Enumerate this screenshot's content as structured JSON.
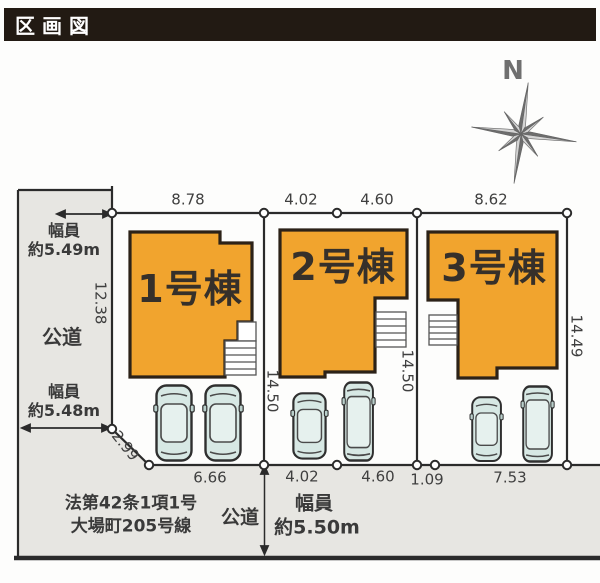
{
  "header": {
    "title": "区画図"
  },
  "compass": {
    "north_label": "N"
  },
  "dims": {
    "top": [
      "8.78",
      "4.02",
      "4.60",
      "8.62"
    ],
    "bottom": [
      "6.66",
      "4.02",
      "4.60",
      "1.09",
      "7.53"
    ],
    "left_boundary": "12.38",
    "corner_diagonal": "2.99",
    "plot2_left": "14.50",
    "plot2_right": "14.50",
    "plot3_right": "14.49"
  },
  "left_road": {
    "width_top_line1": "幅員",
    "width_top_line2": "約5.49m",
    "name": "公道",
    "width_bottom_line1": "幅員",
    "width_bottom_line2": "約5.48m"
  },
  "bottom_road": {
    "law_line1": "法第42条1項1号",
    "law_line2": "大場町205号線",
    "name": "公道",
    "width_line1": "幅員",
    "width_line2": "約5.50m"
  },
  "buildings": [
    {
      "label": "1号棟"
    },
    {
      "label": "2号棟"
    },
    {
      "label": "3号棟"
    }
  ],
  "colors": {
    "building_fill": "#F1A42E",
    "building_outline": "#2C2218",
    "road_fill": "#E7E6E2",
    "line": "#2B2B2B",
    "car_body": "#D7E8E4",
    "title_bar_bg": "#221A13",
    "title_text": "#FFFFFF"
  }
}
